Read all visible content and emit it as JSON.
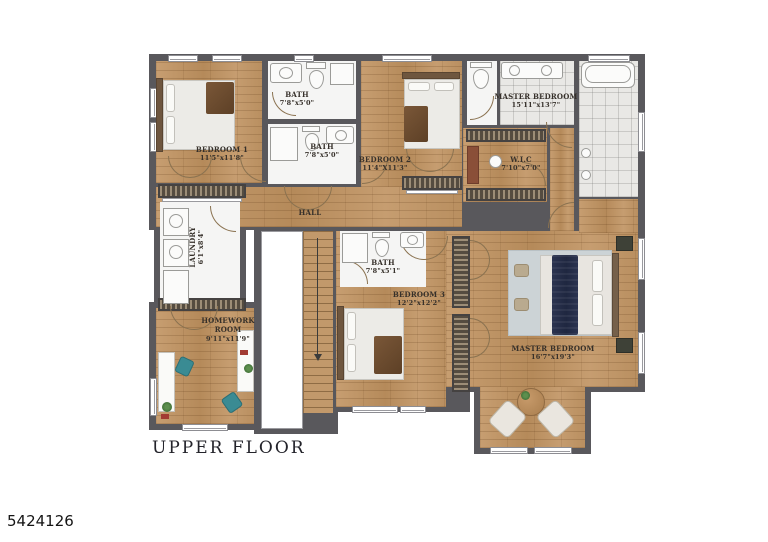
{
  "page": {
    "floor_title": "UPPER FLOOR",
    "listing_number": "5424126"
  },
  "rooms": {
    "bedroom1": {
      "name": "BEDROOM 1",
      "dims": "11'5\"x11'8\""
    },
    "bath_top": {
      "name": "BATH",
      "dims": "7'8\"x5'0\""
    },
    "bath_mid": {
      "name": "BATH",
      "dims": "7'8\"x5'0\""
    },
    "bedroom2": {
      "name": "BEDROOM 2",
      "dims": "11'4\"X11'3\""
    },
    "master_bath": {
      "name": "MASTER BEDROOM",
      "dims": "15'11\"x13'7\""
    },
    "wic": {
      "name": "W.I.C",
      "dims": "7'10\"x7'0\""
    },
    "hall": {
      "name": "HALL"
    },
    "laundry": {
      "name": "LAUNDRY",
      "dims": "6'1\"x8'4\""
    },
    "bath3": {
      "name": "BATH",
      "dims": "7'8\"x5'1\""
    },
    "bedroom3": {
      "name": "BEDROOM 3",
      "dims": "12'2\"x12'2\""
    },
    "homework": {
      "name": "HOMEWORK ROOM",
      "dims": "9'11\"x11'9\""
    },
    "master_bedroom": {
      "name": "MASTER BEDROOM",
      "dims": "16'7\"x19'3\""
    }
  },
  "colors": {
    "wall": "#59585c",
    "wood": "#c2996b",
    "tile": "#e9e8e5",
    "accent_navy": "#28304a",
    "accent_teal": "#3a8b93"
  }
}
